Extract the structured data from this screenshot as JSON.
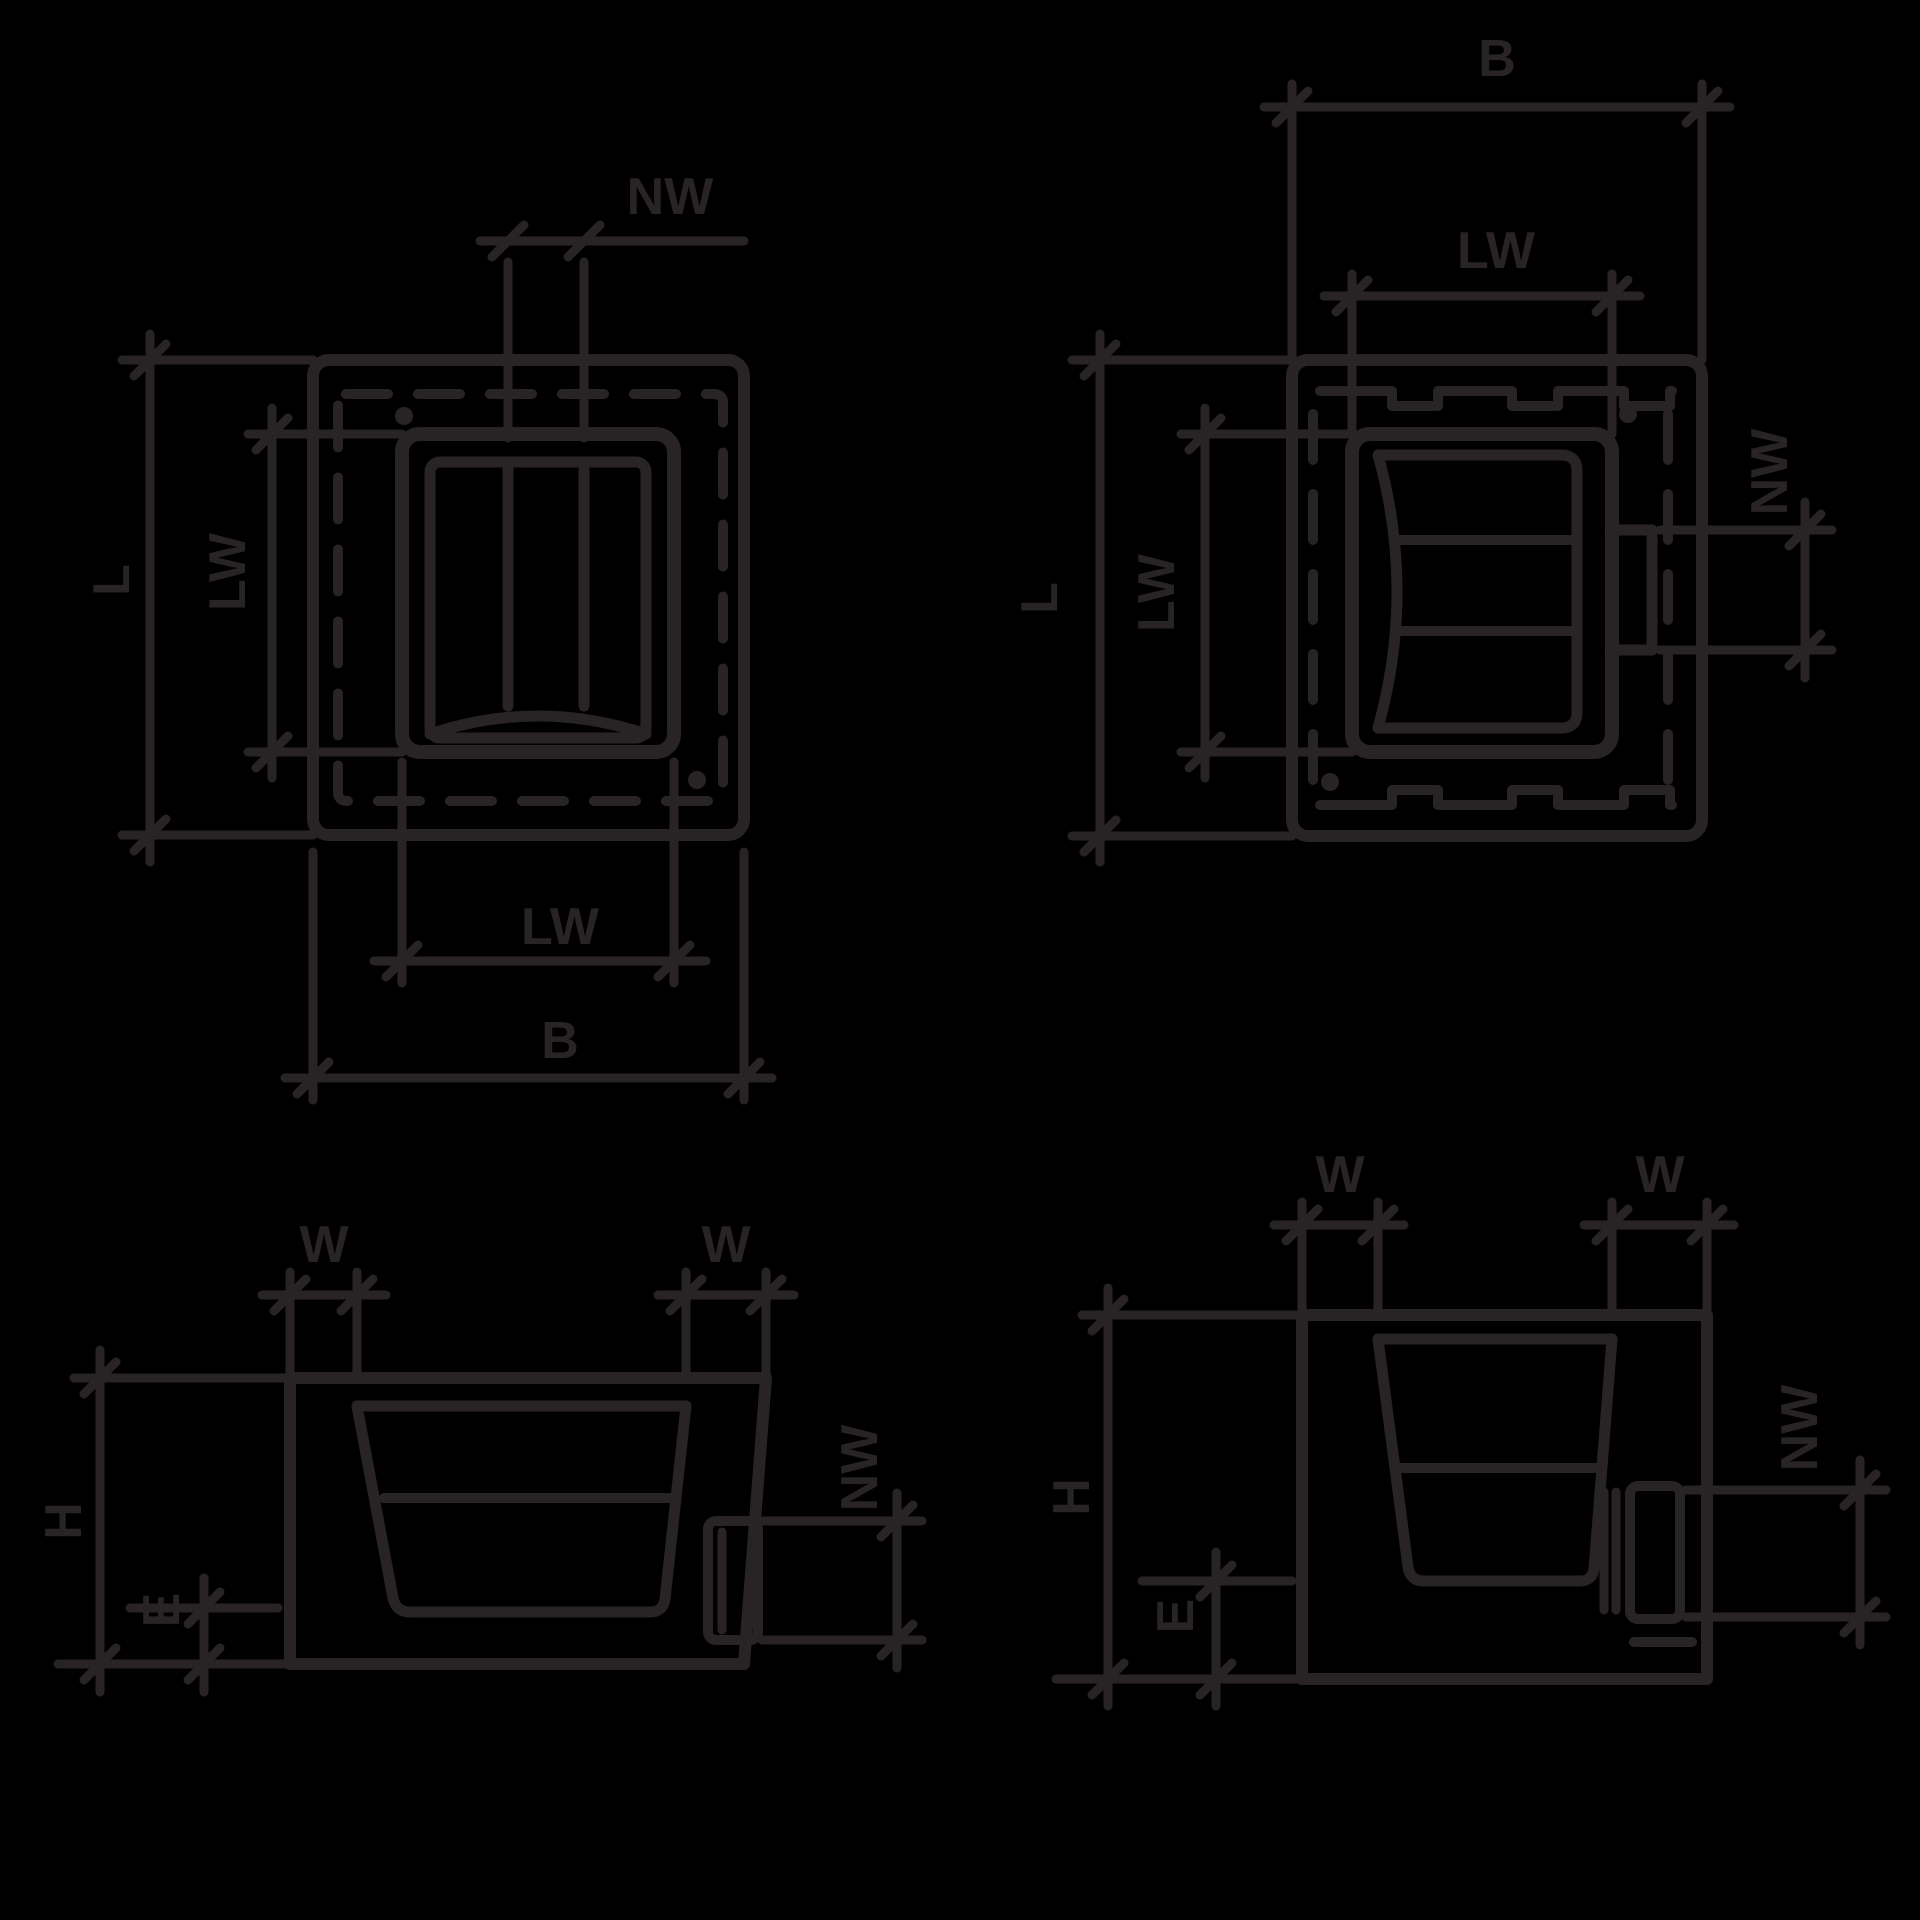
{
  "colors": {
    "background": "#000000",
    "line": "#282324"
  },
  "views": {
    "plan_top": {
      "nw": "NW",
      "l": "L",
      "lw_side": "LW",
      "lw_bottom": "LW",
      "b": "B"
    },
    "plan_underside": {
      "b": "B",
      "lw_top": "LW",
      "l": "L",
      "lw_side": "LW",
      "nw": "NW"
    },
    "section_left": {
      "w_left": "W",
      "w_right": "W",
      "h": "H",
      "e": "E",
      "nw": "NW"
    },
    "section_right": {
      "w_left": "W",
      "w_right": "W",
      "h": "H",
      "e": "E",
      "nw": "NW"
    }
  }
}
